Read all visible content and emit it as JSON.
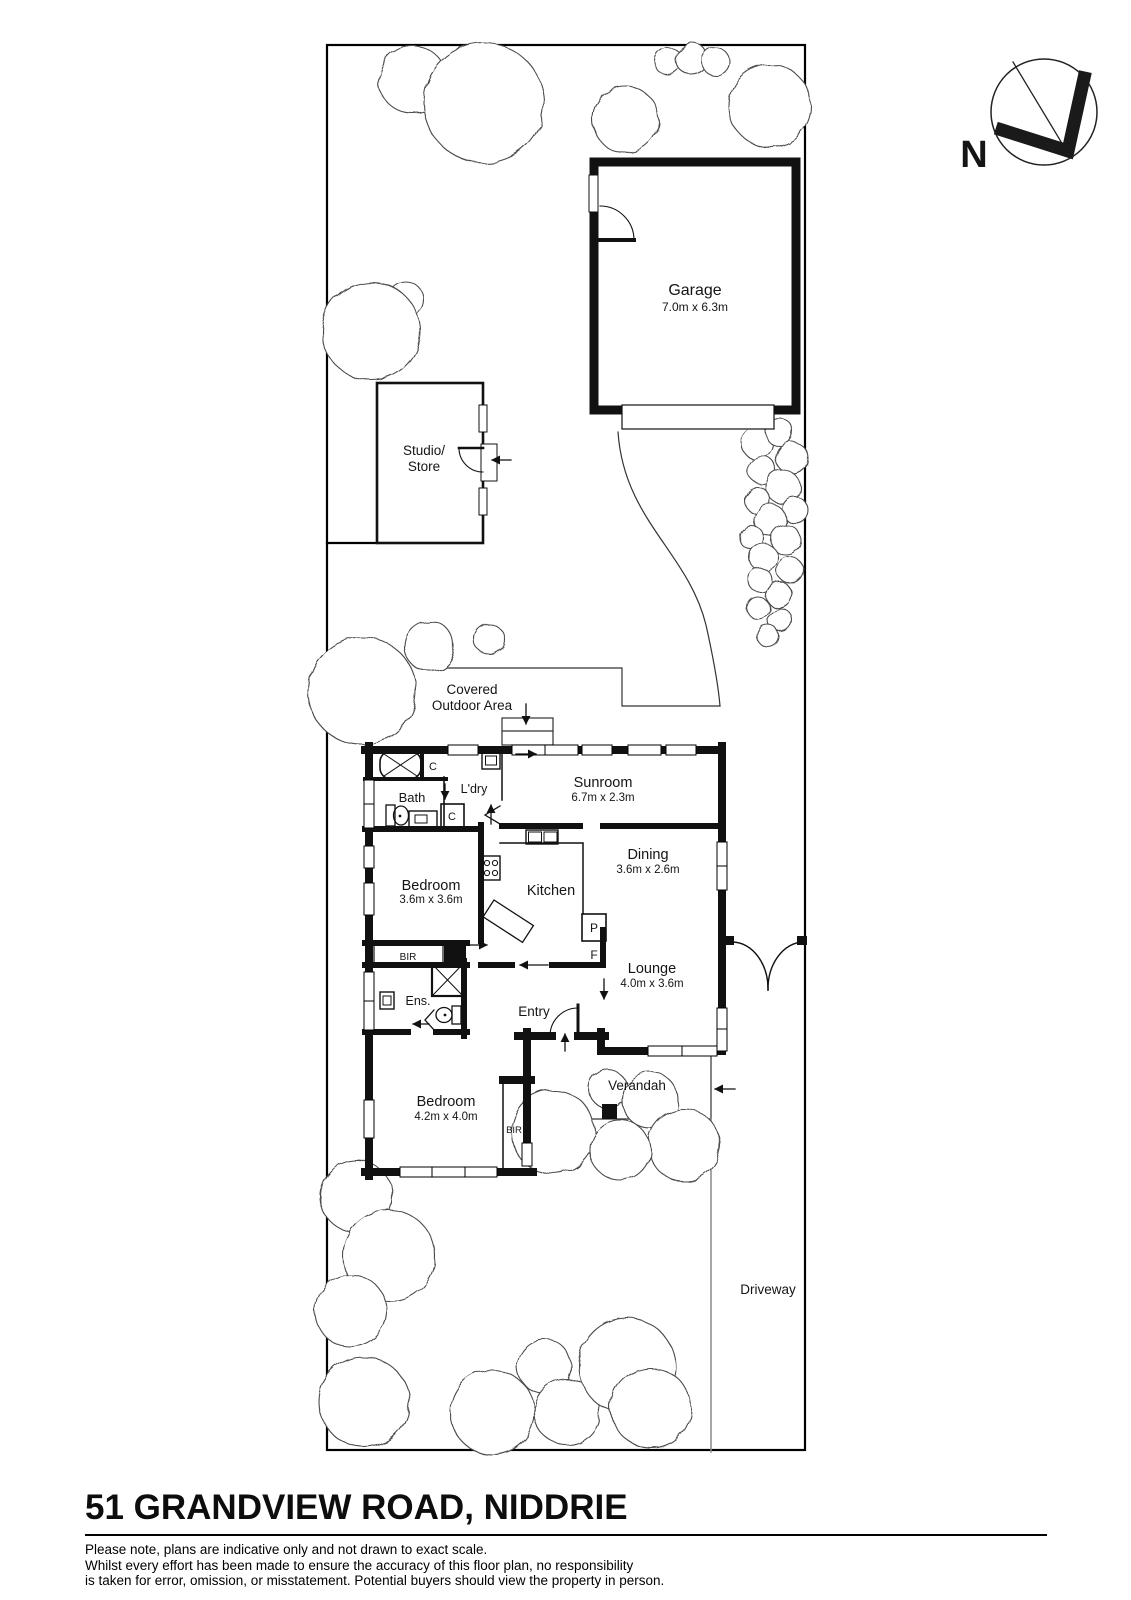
{
  "title": "51 GRANDVIEW ROAD, NIDDRIE",
  "disclaimer": {
    "line1": "Please note, plans are indicative only and not drawn to exact scale.",
    "line2": "Whilst every effort has been made to ensure the accuracy of this floor plan, no responsibility",
    "line3": "is taken for error, omission, or misstatement. Potential buyers should view the property in person."
  },
  "compass": {
    "north_label": "N"
  },
  "site": {
    "garage": {
      "name": "Garage",
      "dims": "7.0m x 6.3m"
    },
    "studio": {
      "line1": "Studio/",
      "line2": "Store"
    },
    "covered_outdoor_area": {
      "line1": "Covered",
      "line2": "Outdoor Area"
    },
    "driveway": "Driveway",
    "verandah": "Verandah"
  },
  "rooms": {
    "sunroom": {
      "name": "Sunroom",
      "dims": "6.7m x 2.3m"
    },
    "dining": {
      "name": "Dining",
      "dims": "3.6m x 2.6m"
    },
    "lounge": {
      "name": "Lounge",
      "dims": "4.0m x 3.6m"
    },
    "kitchen": {
      "name": "Kitchen"
    },
    "bath": {
      "name": "Bath"
    },
    "laundry": {
      "name": "L'dry"
    },
    "ensuite": {
      "name": "Ens."
    },
    "entry": {
      "name": "Entry"
    },
    "bedroom_middle": {
      "name": "Bedroom",
      "dims": "3.6m x 3.6m"
    },
    "bedroom_front": {
      "name": "Bedroom",
      "dims": "4.2m x 4.0m"
    }
  },
  "fixtures": {
    "bir": "BIR",
    "cupboard": "C",
    "pantry": "P",
    "fridge": "F"
  }
}
